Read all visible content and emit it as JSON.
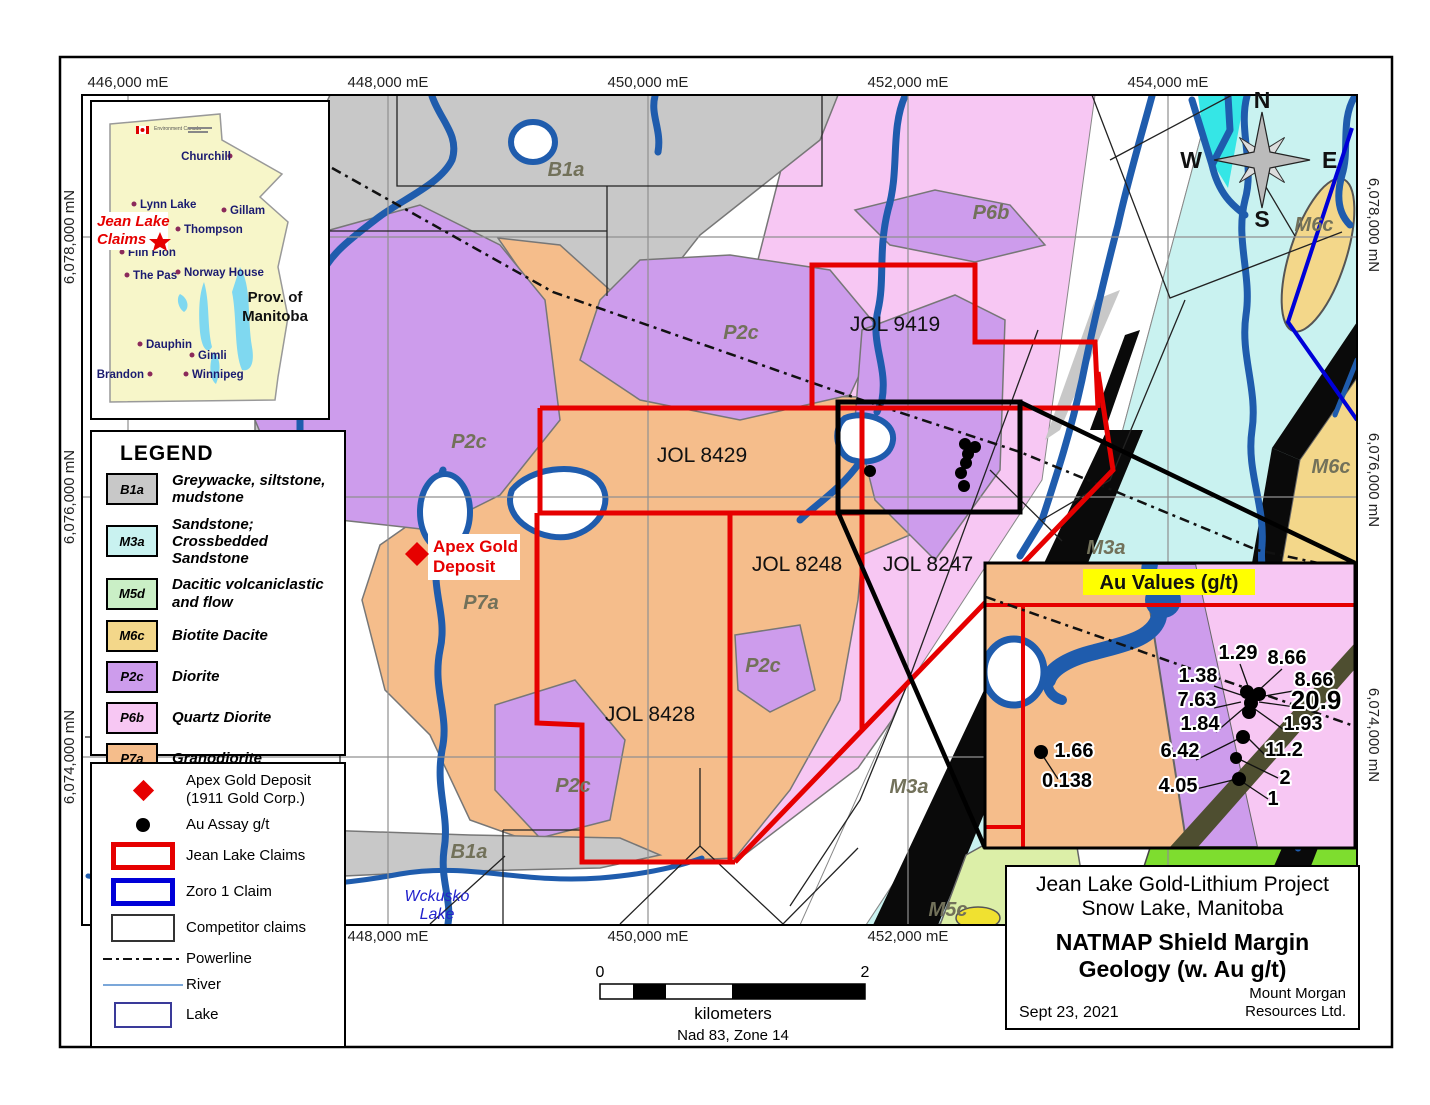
{
  "frame": {
    "top_labels": [
      "446,000 mE",
      "448,000 mE",
      "450,000 mE",
      "452,000 mE",
      "454,000 mE"
    ],
    "bottom_labels": [
      "448,000 mE",
      "450,000 mE",
      "452,000 mE"
    ],
    "left_labels": [
      "6,078,000 mN",
      "6,076,000 mN",
      "6,074,000 mN"
    ],
    "right_labels": [
      "6,078,000 mN",
      "6,076,000 mN",
      "6,074,000 mN"
    ]
  },
  "compass": {
    "n": "N",
    "e": "E",
    "s": "S",
    "w": "W"
  },
  "manitoba_inset": {
    "flag_label": "Environment Canada",
    "claims_line1": "Jean Lake",
    "claims_line2": "Claims",
    "province_line1": "Prov.  of",
    "province_line2": "Manitoba",
    "cities": [
      "Churchill",
      "Lynn Lake",
      "Gillam",
      "Thompson",
      "Flin Flon",
      "Norway House",
      "The Pas",
      "Dauphin",
      "Gimli",
      "Brandon",
      "Winnipeg"
    ]
  },
  "legend": {
    "title": "LEGEND",
    "items": [
      {
        "code": "B1a",
        "label": "Greywacke, siltstone,\nmudstone",
        "color": "#c8c8c8"
      },
      {
        "code": "M3a",
        "label": "Sandstone;\nCrossbedded Sandstone",
        "color": "#c9f2f0"
      },
      {
        "code": "M5d",
        "label": "Dacitic volcaniclastic\nand flow",
        "color": "#caefc6"
      },
      {
        "code": "M6c",
        "label": "Biotite Dacite",
        "color": "#f3d78a"
      },
      {
        "code": "P2c",
        "label": "Diorite",
        "color": "#cd9cec"
      },
      {
        "code": "P6b",
        "label": "Quartz Diorite",
        "color": "#f7c7f3"
      },
      {
        "code": "P7a",
        "label": "Granodiorite",
        "color": "#f5bd8b"
      }
    ]
  },
  "map_symbols": {
    "items": [
      {
        "icon": "red-diamond",
        "label": "Apex Gold Deposit\n(1911 Gold Corp.)"
      },
      {
        "icon": "black-dot",
        "label": "Au Assay g/t"
      },
      {
        "icon": "red-rectangle",
        "label": "Jean Lake Claims"
      },
      {
        "icon": "blue-rectangle",
        "label": "Zoro 1 Claim"
      },
      {
        "icon": "black-rectangle",
        "label": "Competitor claims"
      },
      {
        "icon": "dash-dot-line",
        "label": "Powerline"
      },
      {
        "icon": "light-blue-line",
        "label": "River"
      },
      {
        "icon": "navy-rectangle",
        "label": "Lake"
      }
    ]
  },
  "map": {
    "claim_labels": [
      "JOL 9419",
      "JOL 8429",
      "JOL 8248",
      "JOL 8247",
      "JOL 8428"
    ],
    "unit_labels": [
      "B1a",
      "P6b",
      "P2c",
      "P2c",
      "P7a",
      "P2c",
      "P2c",
      "B1a",
      "M3a",
      "M6c",
      "M6c",
      "M3a",
      "M5c"
    ],
    "apex_line1": "Apex Gold",
    "apex_line2": "Deposit",
    "lake_line1": "Wckusko",
    "lake_line2": "Lake"
  },
  "au_inset": {
    "title": "Au Values (g/t)",
    "values": [
      "1.29",
      "8.66",
      "1.38",
      "8.66",
      "7.63",
      "20.9",
      "1.84",
      "1.93",
      "1.66",
      "6.42",
      "11.2",
      "0.138",
      "4.05",
      "2",
      "1"
    ]
  },
  "scale_bar": {
    "start": "0",
    "end": "2",
    "units": "kilometers",
    "datum": "Nad 83, Zone 14"
  },
  "title_block": {
    "project_line1": "Jean Lake Gold-Lithium Project",
    "project_line2": "Snow Lake, Manitoba",
    "map_title_line1": "NATMAP Shield Margin",
    "map_title_line2": "Geology (w. Au g/t)",
    "date": "Sept 23, 2021",
    "company_line1": "Mount Morgan",
    "company_line2": "Resources Ltd."
  },
  "colors": {
    "claim_red": "#e60000",
    "zoro_blue": "#0000d8",
    "river_blue": "#1f5cad",
    "highlight_yellow": "#ffff00",
    "granodiorite_orange": "#f5bd8b",
    "diorite_purple": "#cd9cec",
    "quartz_diorite_pink": "#f7c7f3",
    "sandstone_cyan": "#c9f2f0",
    "greywacke_gray": "#c8c8c8"
  }
}
